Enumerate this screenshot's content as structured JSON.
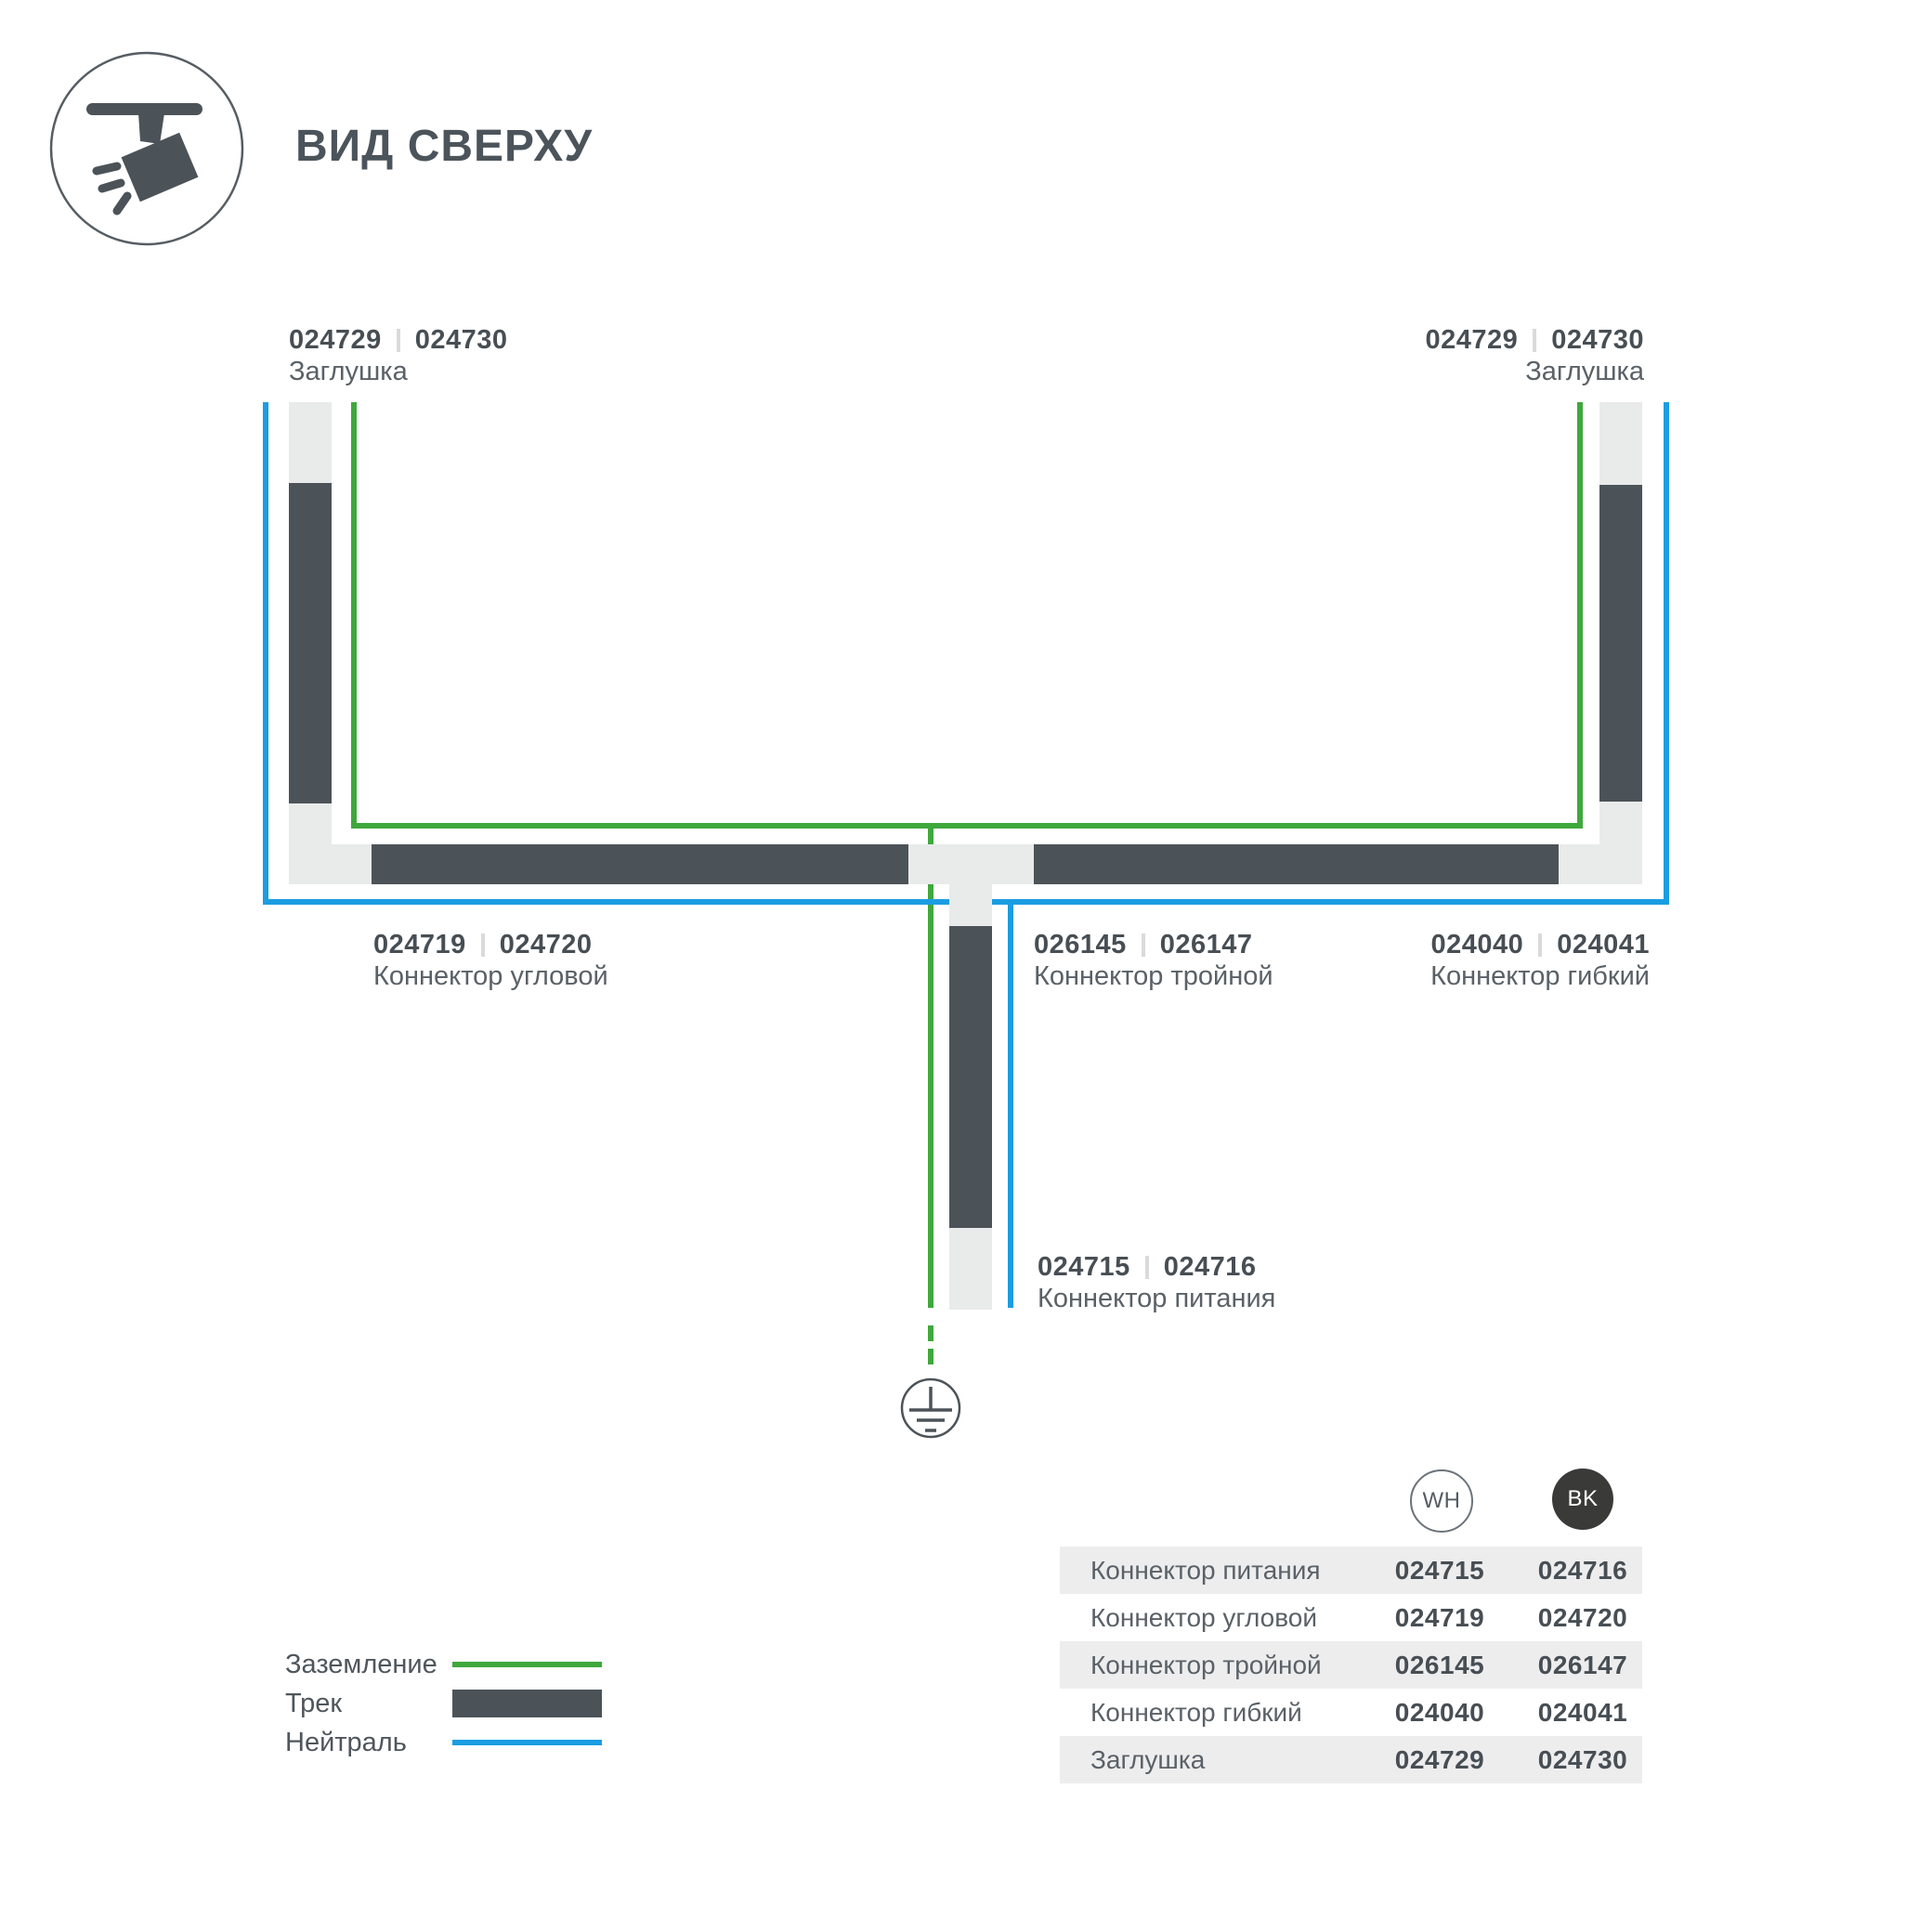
{
  "header": {
    "title": "ВИД СВЕРХУ"
  },
  "icons": {
    "header": "track-spotlight-top-view-icon",
    "ground": "earth-ground-icon"
  },
  "colors": {
    "ground_green": "#3fa83c",
    "neutral_blue": "#1b9de2",
    "track_dark": "#4c5358",
    "track_light": "#e9eaea",
    "text_dark": "#474e54",
    "text_gray": "#5a6167",
    "row_gray": "#ededee"
  },
  "diagram": {
    "labels": {
      "endcap_left": {
        "wh": "024729",
        "bk": "024730",
        "name": "Заглушка"
      },
      "endcap_right": {
        "wh": "024729",
        "bk": "024730",
        "name": "Заглушка"
      },
      "corner": {
        "wh": "024719",
        "bk": "024720",
        "name": "Коннектор угловой"
      },
      "triple": {
        "wh": "026145",
        "bk": "026147",
        "name": "Коннектор тройной"
      },
      "flexible": {
        "wh": "024040",
        "bk": "024041",
        "name": "Коннектор гибкий"
      },
      "power": {
        "wh": "024715",
        "bk": "024716",
        "name": "Коннектор питания"
      }
    }
  },
  "legend": {
    "items": [
      {
        "label": "Заземление",
        "type": "ground"
      },
      {
        "label": "Трек",
        "type": "track"
      },
      {
        "label": "Нейтраль",
        "type": "neutral"
      }
    ]
  },
  "table": {
    "columns": [
      {
        "badge": "WH"
      },
      {
        "badge": "BK"
      }
    ],
    "rows": [
      {
        "name": "Коннектор питания",
        "wh": "024715",
        "bk": "024716"
      },
      {
        "name": "Коннектор угловой",
        "wh": "024719",
        "bk": "024720"
      },
      {
        "name": "Коннектор тройной",
        "wh": "026145",
        "bk": "026147"
      },
      {
        "name": "Коннектор гибкий",
        "wh": "024040",
        "bk": "024041"
      },
      {
        "name": "Заглушка",
        "wh": "024729",
        "bk": "024730"
      }
    ]
  }
}
